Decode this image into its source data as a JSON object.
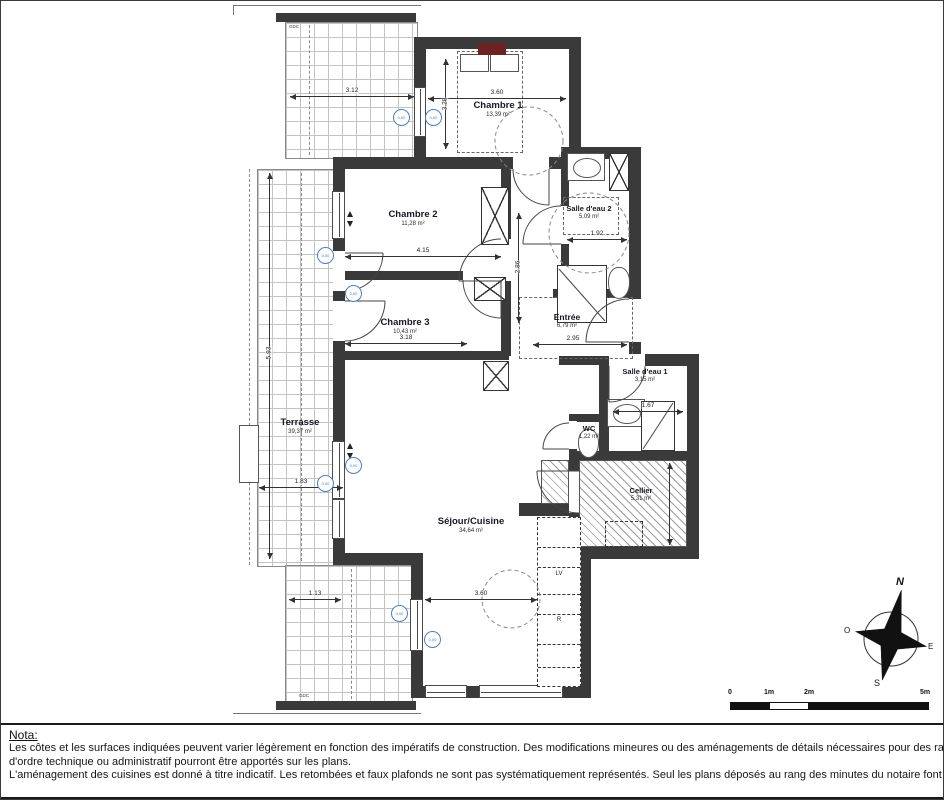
{
  "plan": {
    "rooms": {
      "chambre1": {
        "name": "Chambre 1",
        "area": "13,39 m²"
      },
      "chambre2": {
        "name": "Chambre 2",
        "area": "11,28 m²"
      },
      "chambre3": {
        "name": "Chambre 3",
        "area": "10,43 m²"
      },
      "sde2": {
        "name": "Salle d'eau 2",
        "area": "5,09 m²"
      },
      "entree": {
        "name": "Entrée",
        "area": "6,79 m²"
      },
      "sde1": {
        "name": "Salle d'eau 1",
        "area": "3,15 m²"
      },
      "wc": {
        "name": "WC",
        "area": "1,22 m²"
      },
      "cellier": {
        "name": "Cellier",
        "area": "5,31 m²"
      },
      "sejour": {
        "name": "Séjour/Cuisine",
        "area": "34,64 m²"
      },
      "terrasse": {
        "name": "Terrasse",
        "area": "39,37 m²"
      }
    },
    "dims": {
      "ch1_w": "3.60",
      "ch1_h": "3.28",
      "ch2_w": "4.15",
      "ch3_w": "3.18",
      "sde2_w": "1.92",
      "entree_w": "2.95",
      "sde1_w": "1.67",
      "sejour_w": "3.60",
      "terr_bottom": "1.83",
      "terr_top": "3.12",
      "terr_left": "5.93",
      "terr_small": "1.13",
      "corridor_h": "2.86"
    },
    "kitchen": {
      "dishwasher": "LV",
      "fridge": "R"
    },
    "marker_label": "0,00",
    "gdc_top": "GDC",
    "gdc_bottom": "GDC"
  },
  "compass": {
    "north": "N",
    "south": "S",
    "east": "E",
    "west": "O"
  },
  "scale_bar": {
    "zero": "0",
    "one": "1m",
    "two": "2m",
    "five": "5m"
  },
  "nota": {
    "title": "Nota:",
    "line1": "Les côtes et les surfaces indiquées peuvent varier légèrement en fonction des impératifs de construction. Des modifications mineures ou des aménagements de détails nécessaires pour des raisons",
    "line2": "d'ordre technique ou administratif pourront être apportés sur les plans.",
    "line3": "L'aménagement des cuisines est donné à titre indicatif. Les retombées et faux plafonds ne sont pas systématiquement représentés. Seul les plans déposés au rang des minutes du notaire font foi."
  },
  "colors": {
    "wall": "#3a3a3a",
    "accent_blue": "#4d7ebf",
    "bed_accent": "#6b2323"
  }
}
